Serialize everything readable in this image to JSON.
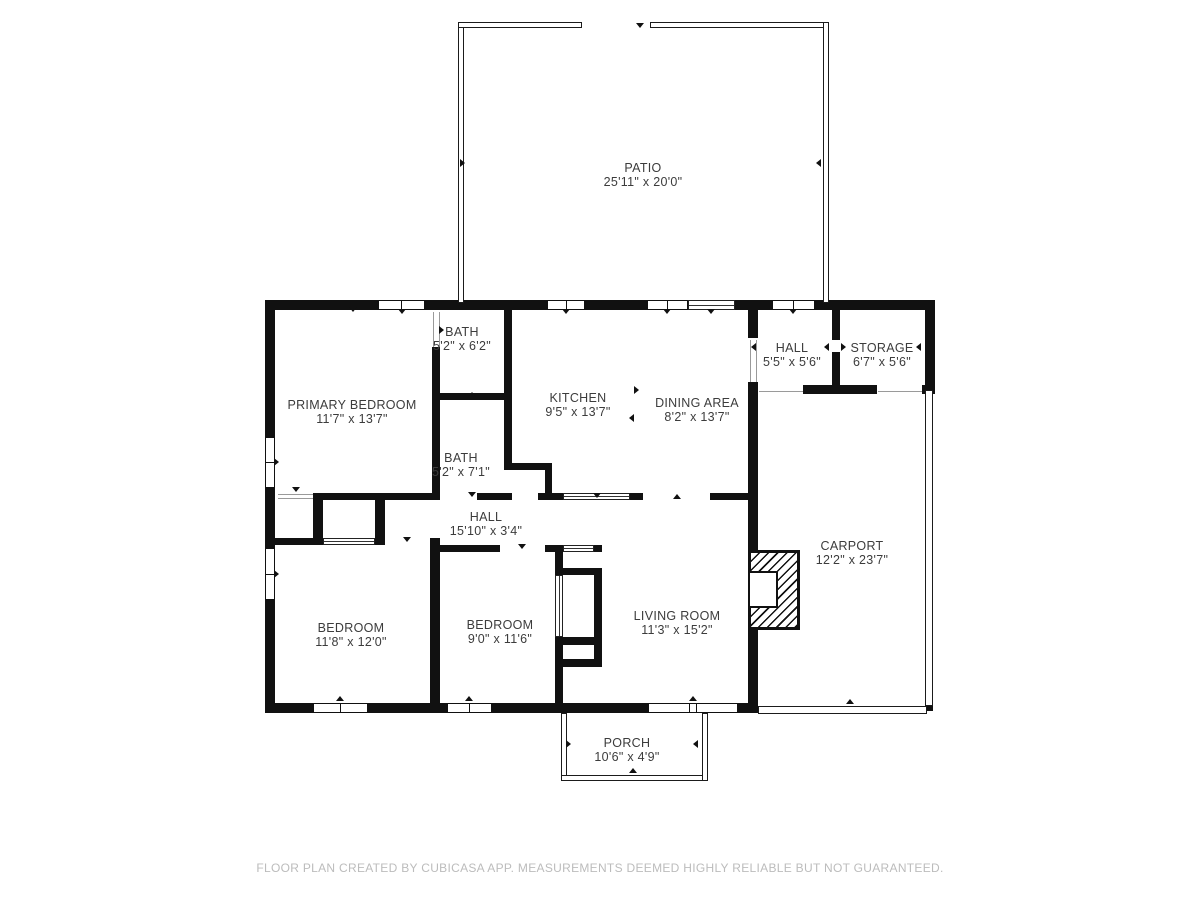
{
  "theme": {
    "wall_color": "#111111",
    "label_color": "#3c3c3c",
    "footer_color": "#bcbcbc",
    "background": "#ffffff"
  },
  "footer": {
    "text": "FLOOR PLAN CREATED BY CUBICASA APP. MEASUREMENTS DEEMED HIGHLY RELIABLE BUT NOT GUARANTEED."
  },
  "rooms": [
    {
      "id": "patio",
      "name": "PATIO",
      "dims": "25'11\" x 20'0\"",
      "x": 643,
      "y": 161
    },
    {
      "id": "bath-upper",
      "name": "BATH",
      "dims": "5'2\" x 6'2\"",
      "x": 462,
      "y": 325
    },
    {
      "id": "primary-bedroom",
      "name": "PRIMARY BEDROOM",
      "dims": "11'7\" x 13'7\"",
      "x": 352,
      "y": 398
    },
    {
      "id": "kitchen",
      "name": "KITCHEN",
      "dims": "9'5\" x 13'7\"",
      "x": 578,
      "y": 391
    },
    {
      "id": "dining-area",
      "name": "DINING AREA",
      "dims": "8'2\" x 13'7\"",
      "x": 697,
      "y": 396
    },
    {
      "id": "hall-entry",
      "name": "HALL",
      "dims": "5'5\" x 5'6\"",
      "x": 792,
      "y": 341
    },
    {
      "id": "storage",
      "name": "STORAGE",
      "dims": "6'7\" x 5'6\"",
      "x": 882,
      "y": 341
    },
    {
      "id": "bath-lower",
      "name": "BATH",
      "dims": "5'2\" x 7'1\"",
      "x": 461,
      "y": 451
    },
    {
      "id": "hall-corridor",
      "name": "HALL",
      "dims": "15'10\" x 3'4\"",
      "x": 486,
      "y": 510
    },
    {
      "id": "carport",
      "name": "CARPORT",
      "dims": "12'2\" x 23'7\"",
      "x": 852,
      "y": 539
    },
    {
      "id": "bedroom-left",
      "name": "BEDROOM",
      "dims": "11'8\" x 12'0\"",
      "x": 351,
      "y": 621
    },
    {
      "id": "bedroom-middle",
      "name": "BEDROOM",
      "dims": "9'0\" x 11'6\"",
      "x": 500,
      "y": 618
    },
    {
      "id": "living-room",
      "name": "LIVING ROOM",
      "dims": "11'3\" x 15'2\"",
      "x": 677,
      "y": 609
    },
    {
      "id": "porch",
      "name": "PORCH",
      "dims": "10'6\" x 4'9\"",
      "x": 627,
      "y": 736
    }
  ],
  "plan": {
    "walls": [
      [
        265,
        300,
        115,
        10
      ],
      [
        425,
        300,
        122,
        10
      ],
      [
        585,
        300,
        62,
        10
      ],
      [
        735,
        300,
        37,
        10
      ],
      [
        815,
        300,
        120,
        10
      ],
      [
        265,
        300,
        10,
        137
      ],
      [
        265,
        488,
        10,
        60
      ],
      [
        265,
        600,
        10,
        113
      ],
      [
        265,
        703,
        48,
        10
      ],
      [
        368,
        703,
        79,
        10
      ],
      [
        492,
        703,
        156,
        10
      ],
      [
        738,
        703,
        20,
        10
      ],
      [
        748,
        310,
        10,
        28
      ],
      [
        748,
        382,
        10,
        170
      ],
      [
        748,
        628,
        10,
        75
      ],
      [
        925,
        300,
        10,
        90
      ],
      [
        803,
        385,
        74,
        9
      ],
      [
        922,
        385,
        13,
        9
      ],
      [
        832,
        310,
        8,
        30
      ],
      [
        832,
        352,
        8,
        33
      ],
      [
        432,
        347,
        8,
        146
      ],
      [
        504,
        310,
        8,
        153
      ],
      [
        432,
        393,
        80,
        7
      ],
      [
        504,
        463,
        48,
        7
      ],
      [
        545,
        470,
        7,
        30
      ],
      [
        426,
        493,
        14,
        7
      ],
      [
        477,
        493,
        35,
        7
      ],
      [
        538,
        493,
        25,
        7
      ],
      [
        630,
        493,
        13,
        7
      ],
      [
        710,
        493,
        48,
        7
      ],
      [
        313,
        493,
        119,
        7
      ],
      [
        313,
        500,
        10,
        45
      ],
      [
        375,
        500,
        10,
        45
      ],
      [
        265,
        538,
        48,
        7
      ],
      [
        375,
        538,
        10,
        7
      ],
      [
        430,
        538,
        10,
        165
      ],
      [
        430,
        545,
        70,
        7
      ],
      [
        545,
        545,
        18,
        7
      ],
      [
        594,
        545,
        8,
        7
      ],
      [
        555,
        552,
        8,
        23
      ],
      [
        555,
        568,
        47,
        7
      ],
      [
        594,
        575,
        8,
        62
      ],
      [
        555,
        637,
        47,
        8
      ],
      [
        555,
        645,
        8,
        14
      ],
      [
        594,
        645,
        8,
        14
      ],
      [
        555,
        659,
        47,
        8
      ],
      [
        555,
        667,
        8,
        36
      ],
      [
        925,
        538,
        8,
        10
      ],
      [
        925,
        695,
        8,
        16
      ]
    ],
    "thin_walls": [
      [
        458,
        22,
        6,
        281
      ],
      [
        458,
        22,
        124,
        6
      ],
      [
        650,
        22,
        179,
        6
      ],
      [
        823,
        22,
        6,
        281
      ],
      [
        561,
        713,
        6,
        68
      ],
      [
        561,
        775,
        147,
        6
      ],
      [
        702,
        713,
        6,
        68
      ],
      [
        925,
        390,
        8,
        316
      ],
      [
        758,
        706,
        169,
        8
      ]
    ],
    "gray_lines": [
      [
        433,
        312,
        1,
        35
      ],
      [
        439,
        312,
        1,
        35
      ],
      [
        750,
        340,
        1,
        42
      ],
      [
        756,
        340,
        1,
        42
      ],
      [
        759,
        391,
        44,
        1
      ],
      [
        878,
        391,
        44,
        1
      ],
      [
        278,
        494,
        35,
        1
      ],
      [
        278,
        498,
        35,
        1
      ]
    ],
    "windows": [
      {
        "r": [
          378,
          300,
          47,
          10
        ],
        "o": "h"
      },
      {
        "r": [
          547,
          300,
          38,
          10
        ],
        "o": "h"
      },
      {
        "r": [
          647,
          300,
          41,
          10
        ],
        "o": "h"
      },
      {
        "r": [
          772,
          300,
          43,
          10
        ],
        "o": "h"
      },
      {
        "r": [
          265,
          437,
          10,
          51
        ],
        "o": "v"
      },
      {
        "r": [
          265,
          548,
          10,
          52
        ],
        "o": "v"
      },
      {
        "r": [
          313,
          703,
          55,
          10
        ],
        "o": "h"
      },
      {
        "r": [
          447,
          703,
          45,
          10
        ],
        "o": "h"
      },
      {
        "r": [
          648,
          703,
          90,
          10
        ],
        "o": "h",
        "m": [
          0.46,
          0.54
        ]
      }
    ],
    "sliders": [
      {
        "r": [
          323,
          538,
          52,
          7
        ],
        "o": "h"
      },
      {
        "r": [
          563,
          545,
          31,
          7
        ],
        "o": "h"
      },
      {
        "r": [
          555,
          575,
          8,
          62
        ],
        "o": "v"
      },
      {
        "r": [
          563,
          493,
          67,
          7
        ],
        "o": "h"
      },
      {
        "r": [
          688,
          300,
          47,
          10
        ],
        "o": "h"
      }
    ],
    "fireplace": {
      "r": [
        748,
        550,
        52,
        80
      ],
      "box": [
        748,
        571,
        30,
        37
      ]
    },
    "ticks": [
      {
        "x": 402,
        "y": 313,
        "d": "down"
      },
      {
        "x": 566,
        "y": 313,
        "d": "down"
      },
      {
        "x": 667,
        "y": 313,
        "d": "down"
      },
      {
        "x": 711,
        "y": 313,
        "d": "down"
      },
      {
        "x": 793,
        "y": 313,
        "d": "down"
      },
      {
        "x": 353,
        "y": 311,
        "d": "down"
      },
      {
        "x": 640,
        "y": 27,
        "d": "down"
      },
      {
        "x": 464,
        "y": 163,
        "d": "right"
      },
      {
        "x": 820,
        "y": 163,
        "d": "left"
      },
      {
        "x": 278,
        "y": 462,
        "d": "right"
      },
      {
        "x": 278,
        "y": 574,
        "d": "right"
      },
      {
        "x": 340,
        "y": 700,
        "d": "up"
      },
      {
        "x": 469,
        "y": 700,
        "d": "up"
      },
      {
        "x": 693,
        "y": 700,
        "d": "up"
      },
      {
        "x": 570,
        "y": 744,
        "d": "right"
      },
      {
        "x": 697,
        "y": 744,
        "d": "left"
      },
      {
        "x": 633,
        "y": 772,
        "d": "up"
      },
      {
        "x": 850,
        "y": 703,
        "d": "up"
      },
      {
        "x": 920,
        "y": 347,
        "d": "left"
      },
      {
        "x": 828,
        "y": 347,
        "d": "left"
      },
      {
        "x": 845,
        "y": 347,
        "d": "right"
      },
      {
        "x": 755,
        "y": 347,
        "d": "left"
      },
      {
        "x": 638,
        "y": 390,
        "d": "right"
      },
      {
        "x": 633,
        "y": 418,
        "d": "left"
      },
      {
        "x": 753,
        "y": 403,
        "d": "right"
      },
      {
        "x": 472,
        "y": 496,
        "d": "down"
      },
      {
        "x": 597,
        "y": 497,
        "d": "down"
      },
      {
        "x": 677,
        "y": 498,
        "d": "up"
      },
      {
        "x": 522,
        "y": 548,
        "d": "down"
      },
      {
        "x": 472,
        "y": 396,
        "d": "up"
      },
      {
        "x": 443,
        "y": 330,
        "d": "right"
      },
      {
        "x": 296,
        "y": 491,
        "d": "down"
      },
      {
        "x": 407,
        "y": 541,
        "d": "down"
      }
    ]
  }
}
